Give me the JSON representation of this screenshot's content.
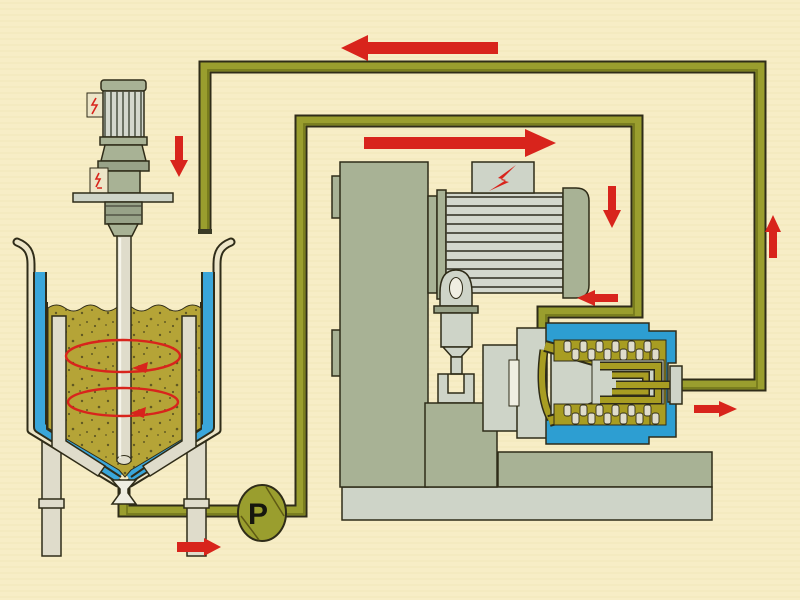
{
  "pump": {
    "label": "P"
  },
  "colors": {
    "bg": "#f7edc6",
    "outline": "#2f2c18",
    "pipe": "#9a9e2e",
    "pipe-core": "#5f6212",
    "arrow": "#d8241c",
    "tank-blue": "#3aa6da",
    "chamber-blue": "#2d9ed2",
    "product": "#b5a437",
    "speck": "#45401c",
    "cream": "#ece5c8",
    "sage": "#a8b295",
    "sage-dark": "#98a288",
    "grey": "#ced4c8",
    "motor-grey": "#d3d7cd",
    "steel": "#dfdccb",
    "channel": "#a89d22",
    "white": "#efeee2"
  },
  "flow_arrows": [
    {
      "name": "return-line-top",
      "direction": "left"
    },
    {
      "name": "tank-inlet",
      "direction": "down"
    },
    {
      "name": "feed-line-top",
      "direction": "right"
    },
    {
      "name": "mill-downcomer",
      "direction": "down"
    },
    {
      "name": "mill-inlet",
      "direction": "left"
    },
    {
      "name": "mill-outlet",
      "direction": "right"
    },
    {
      "name": "riser",
      "direction": "up"
    },
    {
      "name": "pump-suction",
      "direction": "right"
    },
    {
      "name": "tank-swirl-upper",
      "direction": "counterclockwise"
    },
    {
      "name": "tank-swirl-lower",
      "direction": "counterclockwise"
    }
  ]
}
